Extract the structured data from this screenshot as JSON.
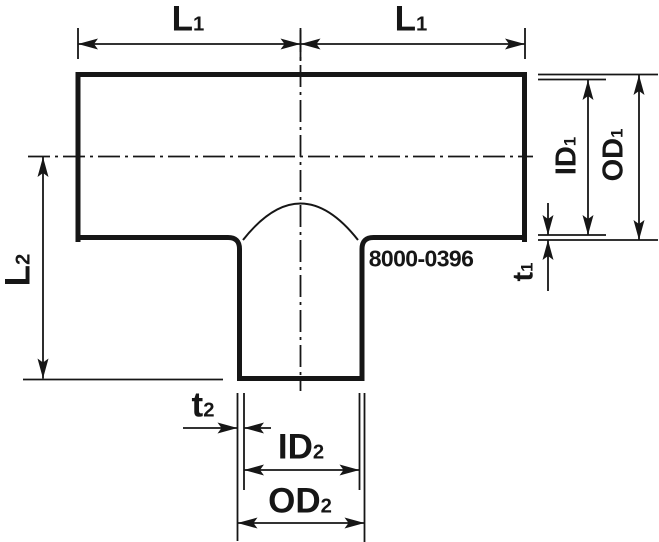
{
  "drawing": {
    "part_number": "8000-0396",
    "colors": {
      "line": "#161616",
      "background": "#ffffff"
    },
    "labels": {
      "l1_left": {
        "main": "L",
        "sub": "1"
      },
      "l1_right": {
        "main": "L",
        "sub": "1"
      },
      "l2": {
        "main": "L",
        "sub": "2"
      },
      "id1": {
        "main": "ID",
        "sub": "1"
      },
      "od1": {
        "main": "OD",
        "sub": "1"
      },
      "t1": {
        "main": "t",
        "sub": "1"
      },
      "t2": {
        "main": "t",
        "sub": "2"
      },
      "id2": {
        "main": "ID",
        "sub": "2"
      },
      "od2": {
        "main": "OD",
        "sub": "2"
      }
    }
  }
}
